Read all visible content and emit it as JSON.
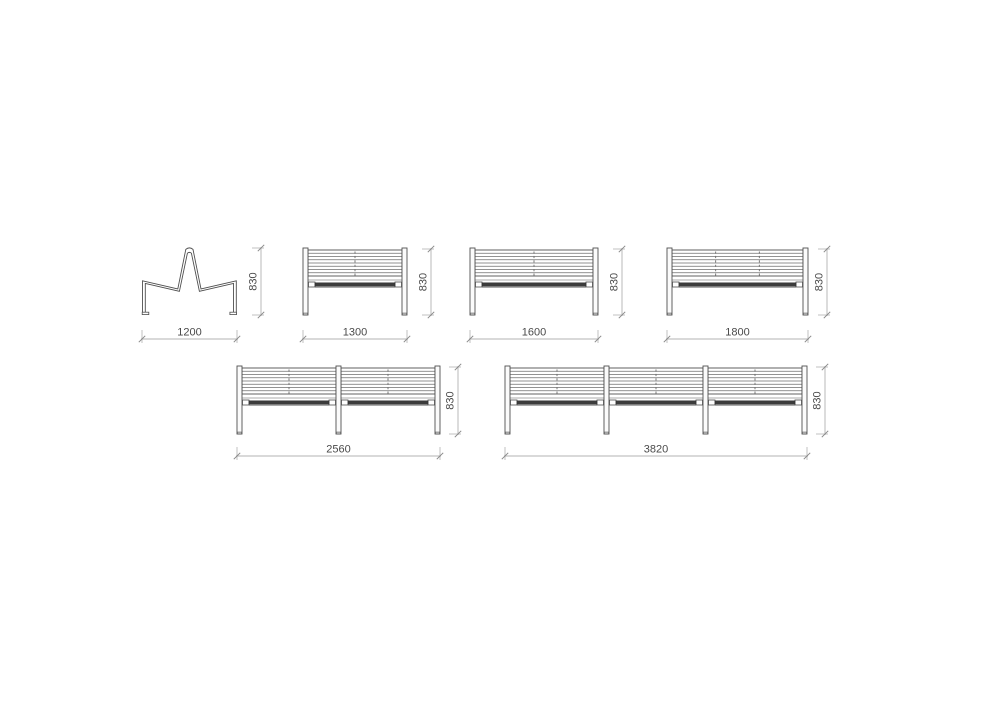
{
  "canvas": {
    "width": 1000,
    "height": 707,
    "background": "#ffffff"
  },
  "style": {
    "line_color": "#4f4f4f",
    "slat_line_color": "#6e6e6e",
    "panel_fill": "#ffffff",
    "leg_fill": "#fbfbfb",
    "leg_cap_color": "#c0c0c0",
    "seat_dark_color": "#3c3c3c",
    "seat_edge_color": "#8f8f8f",
    "dash_color": "#6a6a6a",
    "dim_line_color": "#b3b3b3",
    "dim_tick_color": "#8a8a8a",
    "dim_text_color": "#4a4a4a",
    "dim_font_size": 11
  },
  "dimensions_summary": {
    "height_label_all_views": "830",
    "width_labels": [
      "1200",
      "1300",
      "1600",
      "1800",
      "2560",
      "3820"
    ]
  },
  "views": [
    {
      "name": "bench-side-view",
      "type": "side",
      "x": 142,
      "y": 247,
      "w": 95,
      "h": 68,
      "h_dim": {
        "x1": 142,
        "x2": 237,
        "y": 339,
        "label": "1200"
      },
      "v_dim": {
        "x": 261,
        "y1": 248,
        "y2": 315,
        "label": "830"
      }
    },
    {
      "name": "bench-front-1300",
      "type": "front",
      "bays": 1,
      "dashes_per_bay": 1,
      "x": 303,
      "y": 248,
      "w": 104,
      "h": 67,
      "h_dim": {
        "x1": 303,
        "x2": 407,
        "y": 339,
        "label": "1300"
      },
      "v_dim": {
        "x": 431,
        "y1": 249,
        "y2": 315,
        "label": "830"
      }
    },
    {
      "name": "bench-front-1600",
      "type": "front",
      "bays": 1,
      "dashes_per_bay": 1,
      "x": 470,
      "y": 248,
      "w": 128,
      "h": 67,
      "h_dim": {
        "x1": 470,
        "x2": 598,
        "y": 339,
        "label": "1600"
      },
      "v_dim": {
        "x": 622,
        "y1": 249,
        "y2": 315,
        "label": "830"
      }
    },
    {
      "name": "bench-front-1800",
      "type": "front",
      "bays": 1,
      "dashes_per_bay": 2,
      "x": 667,
      "y": 248,
      "w": 141,
      "h": 67,
      "h_dim": {
        "x1": 667,
        "x2": 808,
        "y": 339,
        "label": "1800"
      },
      "v_dim": {
        "x": 827,
        "y1": 249,
        "y2": 315,
        "label": "830"
      }
    },
    {
      "name": "bench-front-2560",
      "type": "front",
      "bays": 2,
      "dashes_per_bay": 1,
      "x": 237,
      "y": 366,
      "w": 203,
      "h": 68,
      "h_dim": {
        "x1": 237,
        "x2": 440,
        "y": 456,
        "label": "2560"
      },
      "v_dim": {
        "x": 458,
        "y1": 367,
        "y2": 434,
        "label": "830"
      }
    },
    {
      "name": "bench-front-3820",
      "type": "front",
      "bays": 3,
      "dashes_per_bay": 1,
      "x": 505,
      "y": 366,
      "w": 302,
      "h": 68,
      "h_dim": {
        "x1": 505,
        "x2": 807,
        "y": 456,
        "label": "3820"
      },
      "v_dim": {
        "x": 825,
        "y1": 367,
        "y2": 434,
        "label": "830"
      }
    }
  ]
}
